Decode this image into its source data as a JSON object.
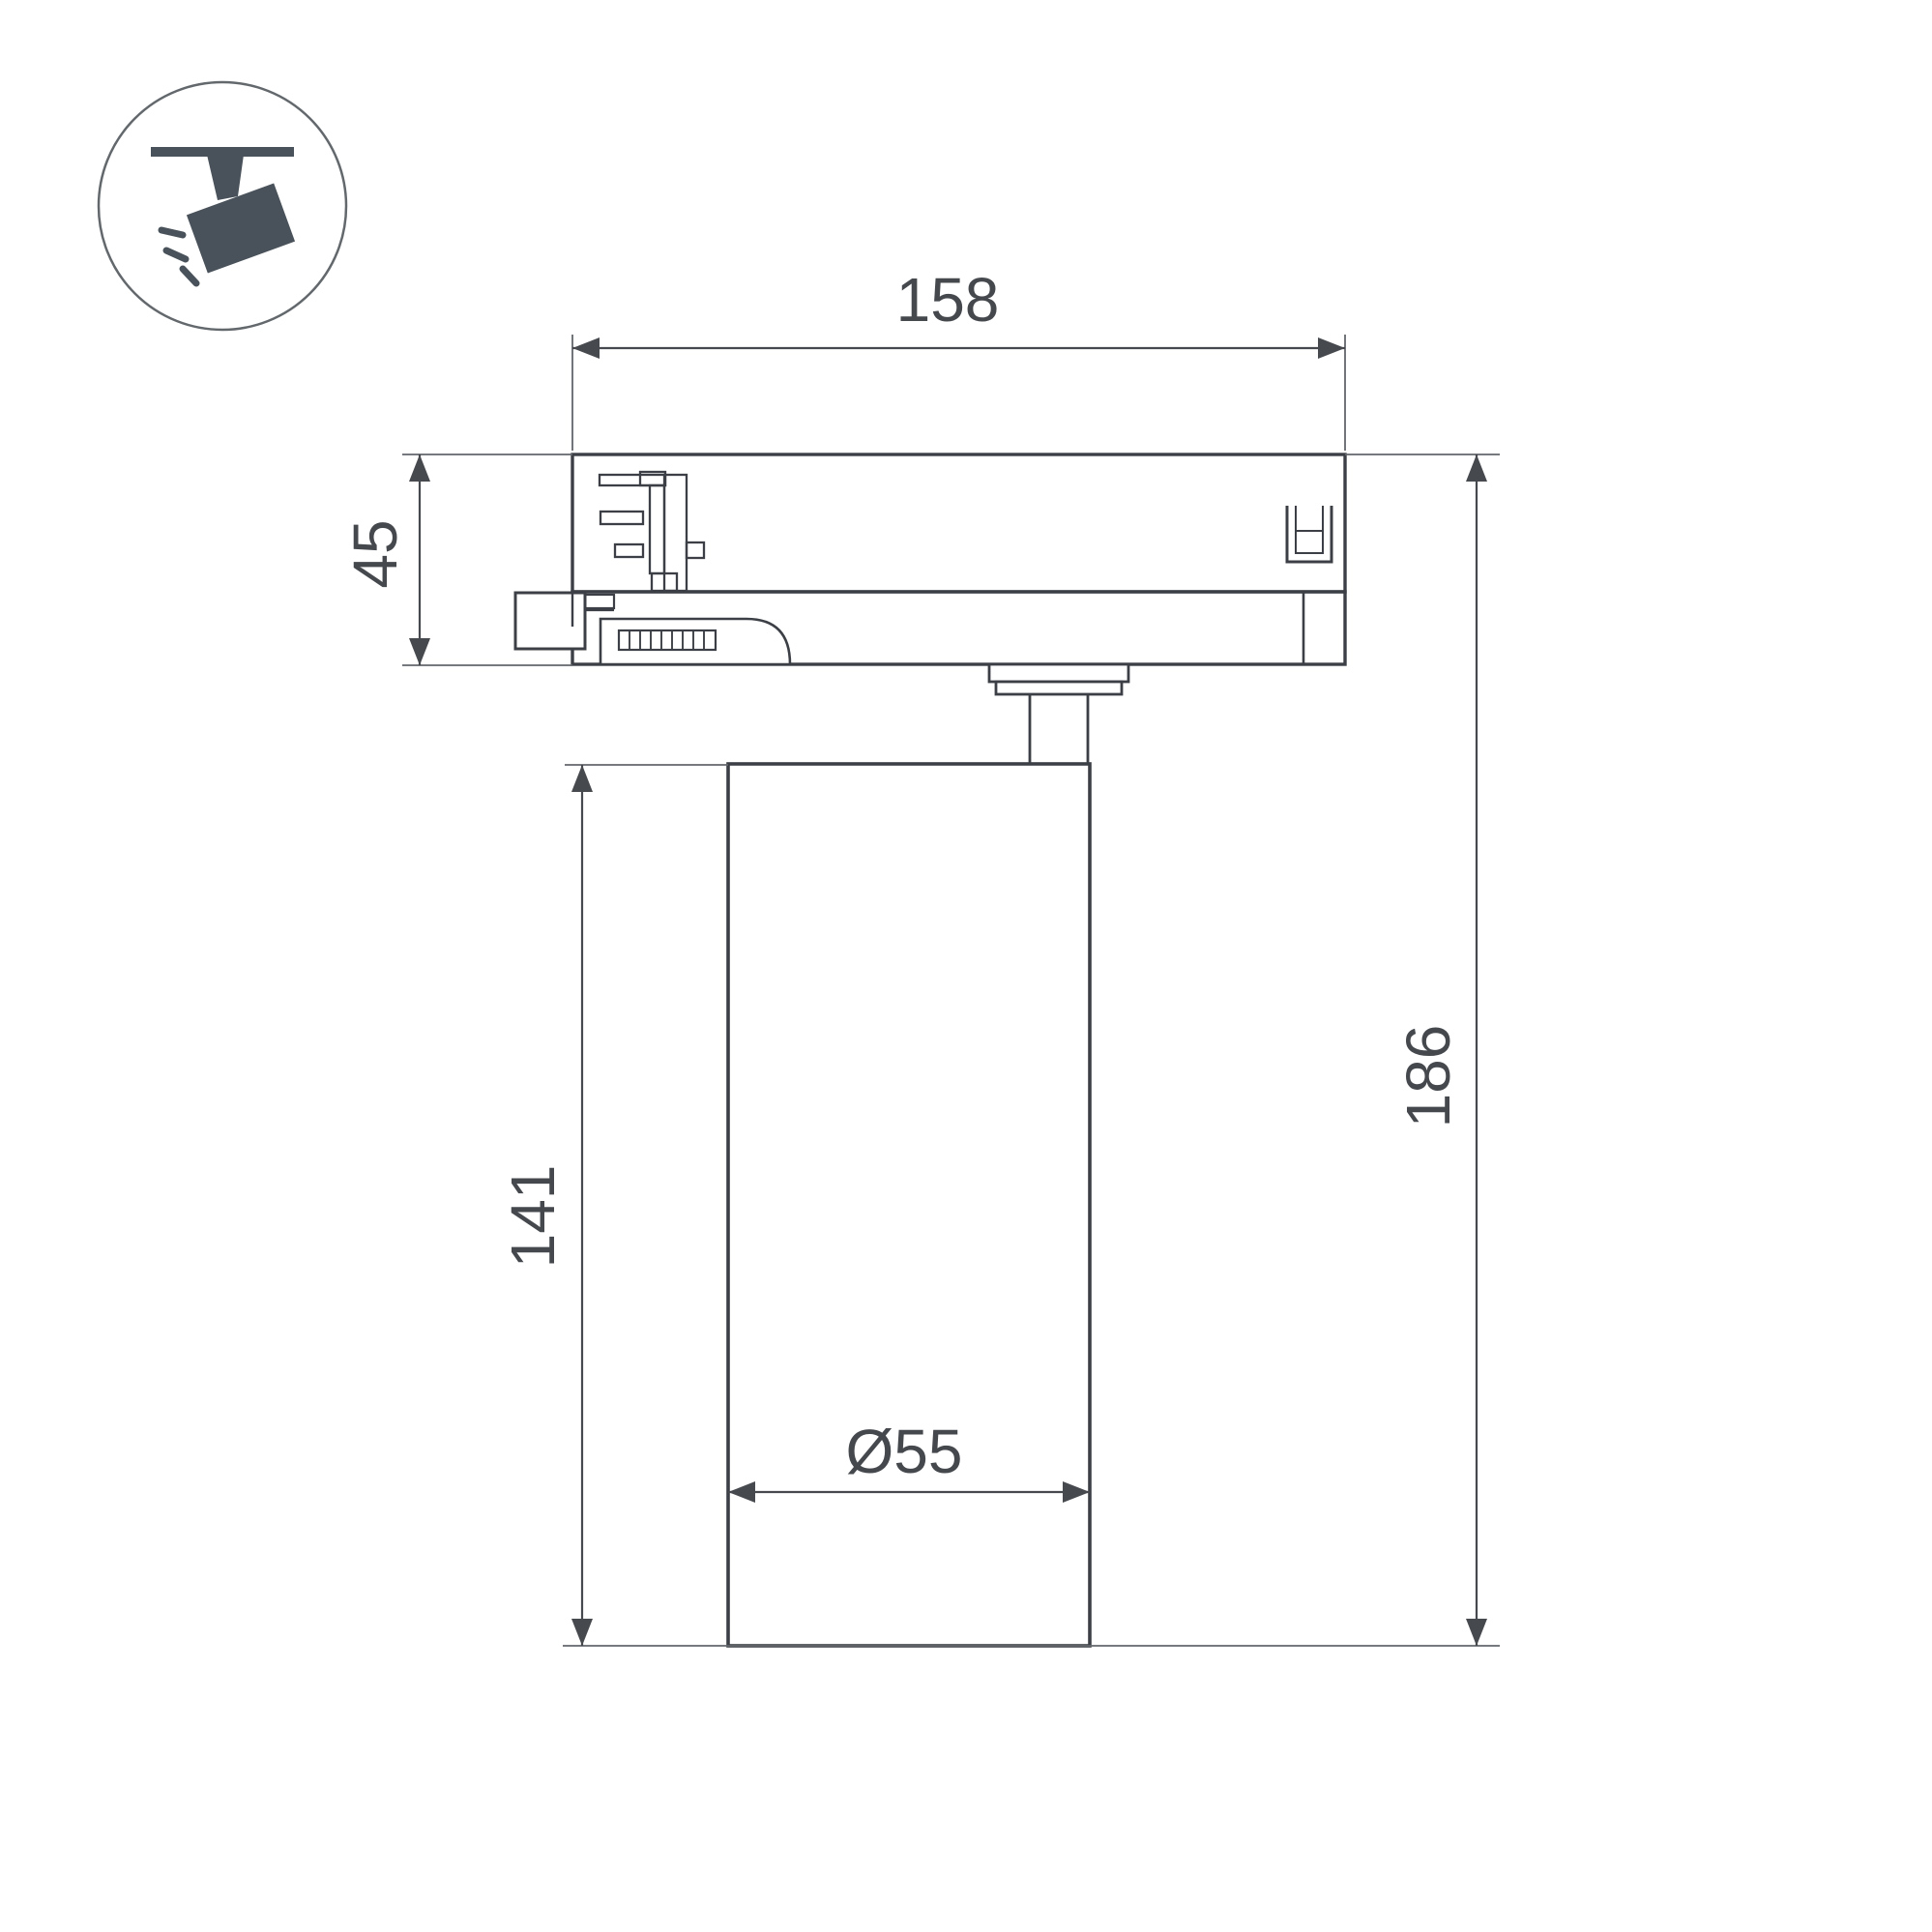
{
  "drawing": {
    "type": "technical-dimension-drawing",
    "subject": "track-light-fixture-side-view",
    "dimensions": {
      "width": "158",
      "adapter_height": "45",
      "body_height": "141",
      "total_height": "186",
      "body_diameter": "Ø55"
    },
    "icon": {
      "name": "track-spotlight-icon",
      "color": "#49525a"
    },
    "colors": {
      "outline": "#3c4046",
      "dimension": "#46494e",
      "extension": "#63676c",
      "text": "#45494e",
      "background": "#ffffff",
      "icon_circle_stroke": "#63686d"
    }
  }
}
